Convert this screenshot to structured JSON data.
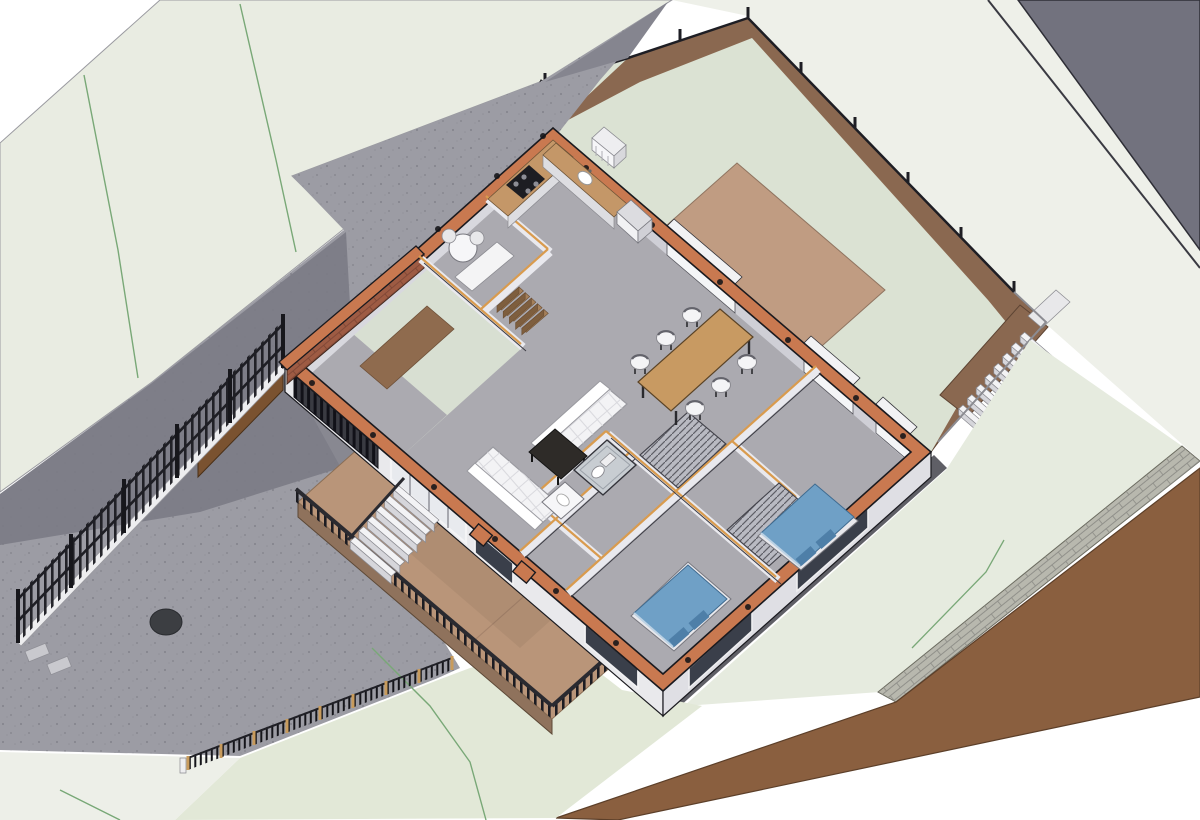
{
  "meta": {
    "view_type": "3d-axonometric-cutaway",
    "subject": "Single-storey house BIM model cut horizontally at section height, shown on a sloped landscaped site",
    "render_style": "architectural section-box render, no visible text",
    "canvas": {
      "width": 1200,
      "height": 820
    }
  },
  "palette": {
    "page_bg": "#ffffff",
    "terrain_pale": "#e9ece2",
    "terrain_white": "#eef0e9",
    "lawn_green": "#e2e8d7",
    "lawn_corner": "#edefe8",
    "backyard_green": "#dbe2d3",
    "driveway_gray": "#9c9ca4",
    "driveway_shadow": "#7b7b85",
    "slope_triangle": "#72727e",
    "earth_brown": "#8a6850",
    "earth_cut": "#8a5f3f",
    "deck_brown": "#b99579",
    "deck_edge": "#8f725c",
    "terrace_brown": "#c09c82",
    "wall_cut_orange": "#c97950",
    "wall_face_light": "#e9e9ec",
    "wall_face_mid": "#d8d8de",
    "wall_face_dark": "#cfcfd6",
    "floor_gray": "#abább0",
    "floor_gray_fix": "#abab b0",
    "floor": "#abaab0",
    "wing_floor": "#d8dfd2",
    "partition_light": "#e9e9ee",
    "partition_top_ochre": "#d99b4e",
    "counter_tan": "#c49768",
    "table_wood": "#c89a62",
    "sofa_white": "#f3f3f5",
    "coffee_table_dark": "#2e2b28",
    "bed_blue": "#6fa0c6",
    "bed_blue_dark": "#4e7fa8",
    "fixture_white": "#f6f6f8",
    "brick_gray": "#b8b8ae",
    "brick_red": "#9e5b43",
    "fence_black": "#1e1e24",
    "fence_post_tan": "#c89b5c",
    "outline": "#1a1a1f",
    "contour_green": "#79a877",
    "glass_dark": "#3a3f4a",
    "ramp_brown": "#8f6b4e",
    "wood_stair": "#a5805a",
    "stair_white": "#f3f3f5",
    "manhole_dark": "#3c3e42"
  },
  "site": {
    "features": [
      "sloped terrain with green contour lines",
      "speckled asphalt driveway with shadow band and round manhole cover",
      "tall black metal fence with posts along driveway",
      "low dark picket fence with tan posts on front lawn",
      "two small gray pavers near fence end",
      "excavated back yard with brown earth retaining slopes",
      "thin black boundary fence on top of excavation edges",
      "brown flat terrace beside rear wall of house",
      "white exterior stair (8 treads) climbing to upper terrain at right",
      "gray brick retaining wall band at lower-right",
      "wide brown earth section cut along bottom-right site edge",
      "neighbor footpath lines and dark gray corner triangle at top-right",
      "timber deck with dark railing at front of house",
      "white entry stair (6 treads) from driveway up to deck"
    ]
  },
  "house": {
    "section_style": "cut walls capped orange-terracotta with small black structural post markers; interior partitions with ochre top lines",
    "rooms": [
      {
        "name": "garage-wing",
        "items": [
          "pale green floor",
          "gray apron at slatted garage door",
          "brown ramp wedge",
          "orange-top brick boundary wall"
        ]
      },
      {
        "name": "utility-room",
        "items": [
          "round white table with 2 chairs",
          "white desk",
          "timber stair (5 treads)"
        ]
      },
      {
        "name": "kitchen",
        "items": [
          "L-shaped counter with tan worktop",
          "black cooktop with 4 burners",
          "white sink",
          "white fridge box"
        ]
      },
      {
        "name": "living-room",
        "items": [
          "long white tufted sofa",
          "small white tufted sofa",
          "dark rectangular coffee table"
        ]
      },
      {
        "name": "dining-area",
        "items": [
          "wood dining table",
          "6 white chairs"
        ]
      },
      {
        "name": "hallway",
        "items": [
          "2 louvered closet units"
        ]
      },
      {
        "name": "bathroom",
        "items": [
          "white vanity with sink",
          "toilet",
          "shower enclosure"
        ]
      },
      {
        "name": "bedroom-front",
        "items": [
          "double bed with blue cover and 2 dark-blue pillows"
        ]
      },
      {
        "name": "bedroom-master",
        "items": [
          "double bed with blue cover and 2 dark-blue pillows"
        ]
      },
      {
        "name": "exterior",
        "items": [
          "white heat-pump unit outside rear wall",
          "glazed openings on all facades",
          "two orange-top porch piers"
        ]
      }
    ],
    "counts": {
      "beds": 2,
      "sofas": 2,
      "dining_chairs": 6,
      "entry_stair_treads": 6,
      "rear_stair_treads": 8,
      "utility_stair_treads": 5,
      "post_markers_on_cut_walls": 20
    }
  }
}
